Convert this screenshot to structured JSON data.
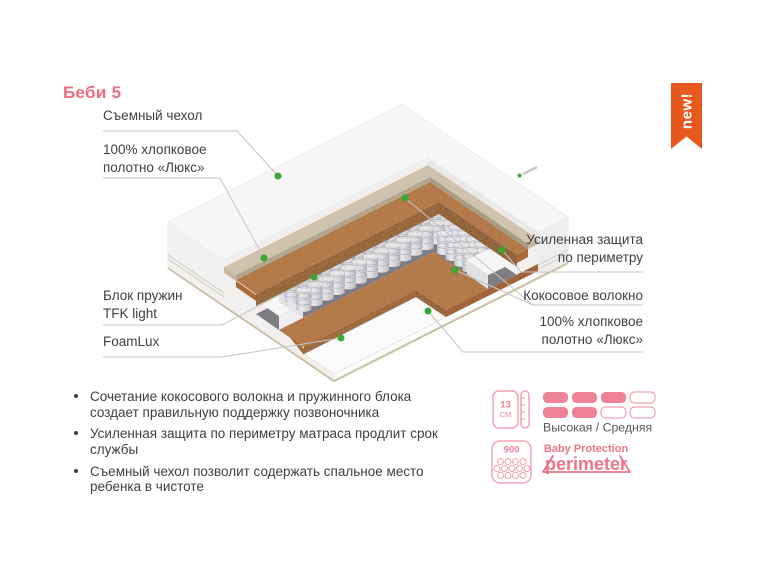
{
  "title": "Беби 5",
  "badge": {
    "label": "new!"
  },
  "mattress_labels": {
    "cover": "Съемный чехол",
    "cotton_top": "100% хлопковое\nполотно «Люкс»",
    "spring_block": "Блок пружин\nTFK light",
    "foamlux": "FoamLux",
    "perimeter": "Усиленная защита\nпо периметру",
    "coconut": "Кокосовое волокно",
    "cotton_bottom": "100% хлопковое\nполотно «Люкс»"
  },
  "features": [
    "Сочетание кокосового волокна и пружинного блока\nсоздает правильную поддержку позвоночника",
    "Усиленная защита по периметру матраса продлит срок\nслужбы",
    "Съемный чехол позволит содержать спальное место\nребенка в чистоте"
  ],
  "specs": {
    "height": {
      "value": "13",
      "unit": "СМ"
    },
    "firmness": {
      "label": "Высокая / Средняя",
      "scale_top": [
        1,
        1,
        1,
        0
      ],
      "scale_bottom": [
        1,
        1,
        0,
        0
      ]
    },
    "springs_count": "900",
    "protection": {
      "line1": "Baby Protection",
      "line2": "perimeter"
    }
  },
  "colors": {
    "title_pink": "#ee6d7d",
    "badge_orange": "#e7581e",
    "dot_green": "#3aa736",
    "icon_pink": "#ee8298",
    "text_dark": "#3f4043"
  }
}
